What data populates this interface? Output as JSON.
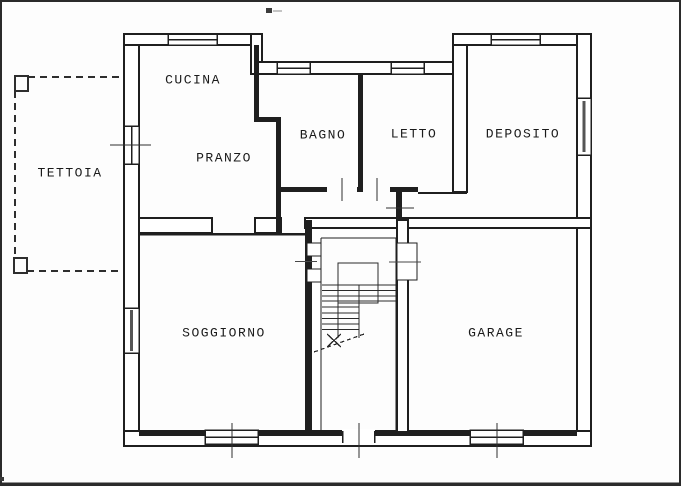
{
  "document": {
    "type": "floor-plan-scan",
    "print_artifact_mark": "▪"
  },
  "colors": {
    "ink": "#1f1f1f",
    "tick": "#474747",
    "paper": "#fdfdfd",
    "border": "#2b2b2b"
  },
  "rooms": {
    "tettoia": {
      "label": "TETTOIA"
    },
    "cucina": {
      "label": "CUCINA"
    },
    "pranzo": {
      "label": "PRANZO"
    },
    "bagno": {
      "label": "BAGNO"
    },
    "letto": {
      "label": "LETTO"
    },
    "deposito": {
      "label": "DEPOSITO"
    },
    "soggiorno": {
      "label": "SOGGIORNO"
    },
    "garage": {
      "label": "GARAGE"
    }
  }
}
